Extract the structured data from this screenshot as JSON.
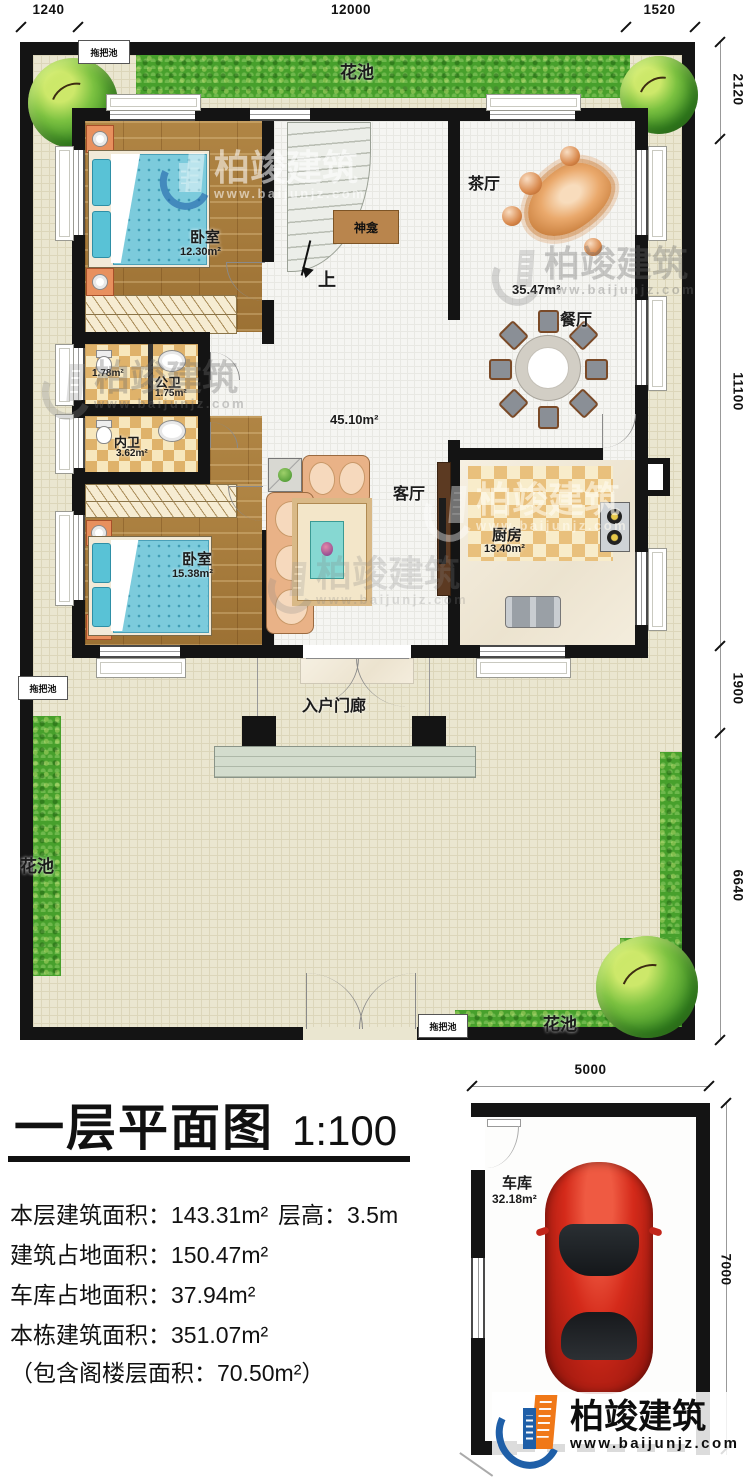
{
  "branding": {
    "name": "柏竣建筑",
    "url": "www.baijunjz.com"
  },
  "title": {
    "text": "一层平面图",
    "scale": "1:100"
  },
  "stats": {
    "floor_area": "本层建筑面积：143.31m²",
    "story_height": "层高：3.5m",
    "footprint": "建筑占地面积：150.47m²",
    "garage_footprint": "车库占地面积：37.94m²",
    "total_area": "本栋建筑面积：351.07m²",
    "attic_note": "（包含阁楼层面积：70.50m²）"
  },
  "dimensions": {
    "top": [
      "1240",
      "12000",
      "1520"
    ],
    "right": [
      "2120",
      "11100",
      "1900",
      "6640"
    ],
    "garage_top": "5000",
    "garage_right": "7000"
  },
  "rooms": {
    "bedroom1": {
      "name": "卧室",
      "area": "12.30m²"
    },
    "bath_a": {
      "area": "1.78m²"
    },
    "public_bath": {
      "name": "公卫",
      "area": "1.75m²"
    },
    "inner_bath": {
      "name": "内卫",
      "area": "3.62m²"
    },
    "bedroom2": {
      "name": "卧室",
      "area": "15.38m²"
    },
    "living": {
      "name": "客厅",
      "area": "45.10m²"
    },
    "tea": {
      "name": "茶厅",
      "area": "35.47m²"
    },
    "dining": {
      "name": "餐厅"
    },
    "kitchen": {
      "name": "厨房",
      "area": "13.40m²"
    },
    "garage": {
      "name": "车库",
      "area": "32.18m²"
    }
  },
  "labels": {
    "shrine": "神龛",
    "up": "上",
    "porch": "入户门廊",
    "flower_bed": "花池",
    "mop_pool": "拖把池"
  }
}
